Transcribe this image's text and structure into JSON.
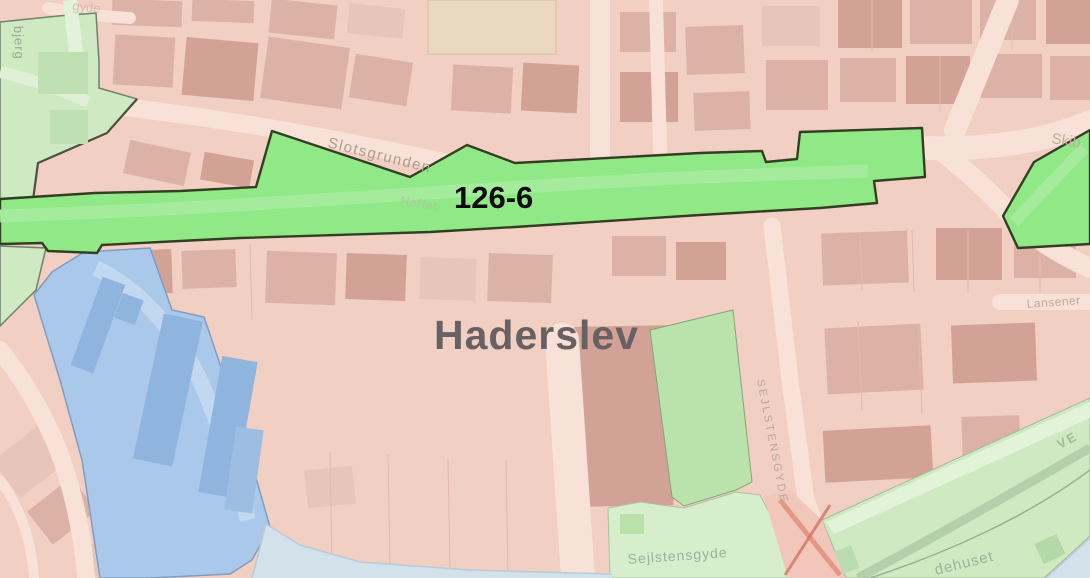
{
  "map": {
    "place_label": "Haderslev",
    "plan_area_label": "126-6",
    "streets": {
      "slotsgrunden": "Slotsgrunden",
      "naffet": "Naffet",
      "sejlstensgyde_upper": "SEJLSTENSGYDE",
      "sejlstensgyde_lower": "Sejlstensgyde",
      "skibbrogade_partial": "Skib",
      "lansenervej_partial": "Lansener",
      "ved_partial": "VE",
      "dehuset_partial": "dehuset",
      "bjerg_partial": "bjerg",
      "gyde_partial": "gyde"
    },
    "colors": {
      "urban_base": "#f2cfc3",
      "building": "#dcb2a6",
      "building_dark": "#d2a296",
      "street_light": "#f8e1d6",
      "zone_green_light": "#cfe9c2",
      "zone_green_mid": "#b9e3ab",
      "zone_green_pale": "#d6eecb",
      "highlight_green": "#90e886",
      "highlight_border": "#333f22",
      "zone_blue": "#aac8e9",
      "building_blue": "#8fb4dd",
      "water": "#d2e1ea",
      "label_dark": "#676163",
      "label_black": "#0c0c0c",
      "street_label": "#b0a198",
      "green_label": "#97b49c"
    }
  }
}
